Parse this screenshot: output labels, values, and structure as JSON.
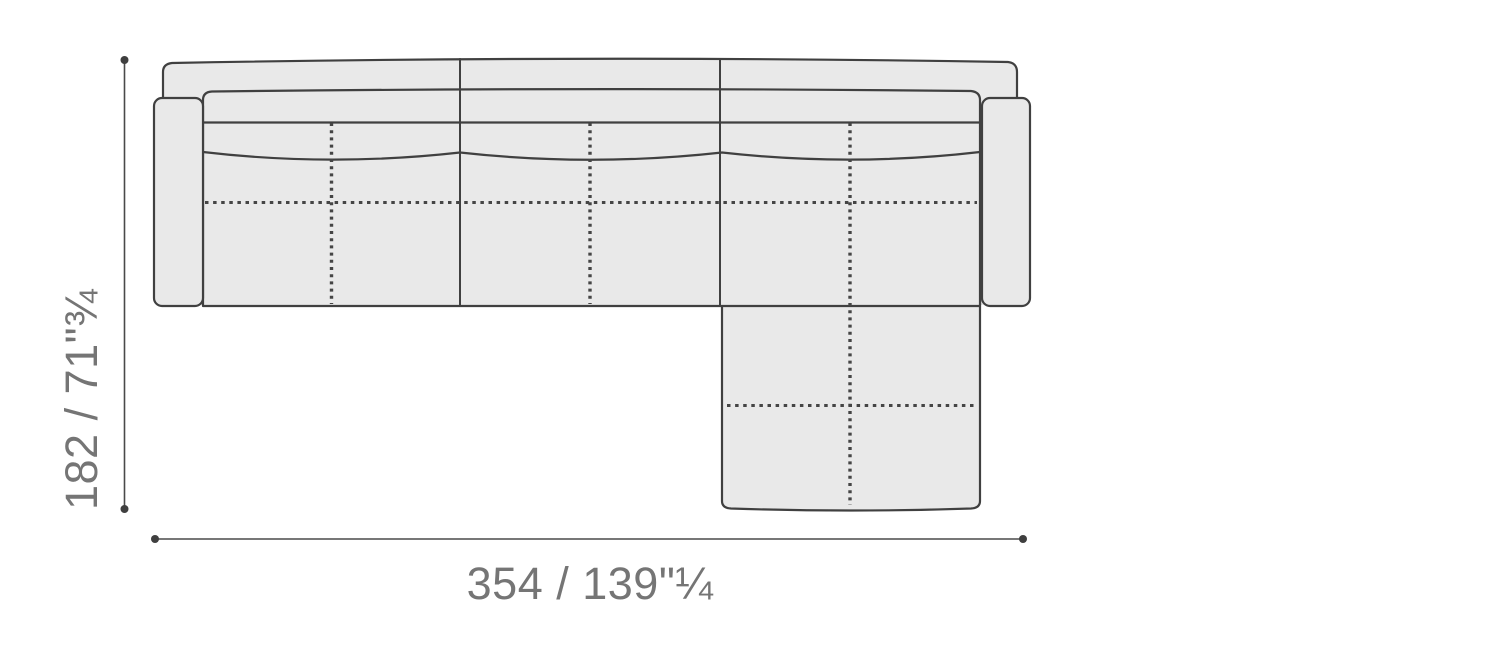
{
  "diagram": {
    "description": "sectional sofa with right chaise, top view dimension drawing",
    "depth_dimension": {
      "label": "182 / 71\"¾",
      "cm": 182,
      "inches": "71¾"
    },
    "width_dimension": {
      "label": "354 / 139\"¼",
      "cm": 354,
      "inches": "139¼"
    }
  },
  "colors": {
    "sofa_fill": "#e9e9e9",
    "sofa_outline": "#404040",
    "stitch_line": "#454545",
    "dimension_line": "#4a4a4a",
    "dimension_text": "#757575",
    "background": "#ffffff"
  }
}
